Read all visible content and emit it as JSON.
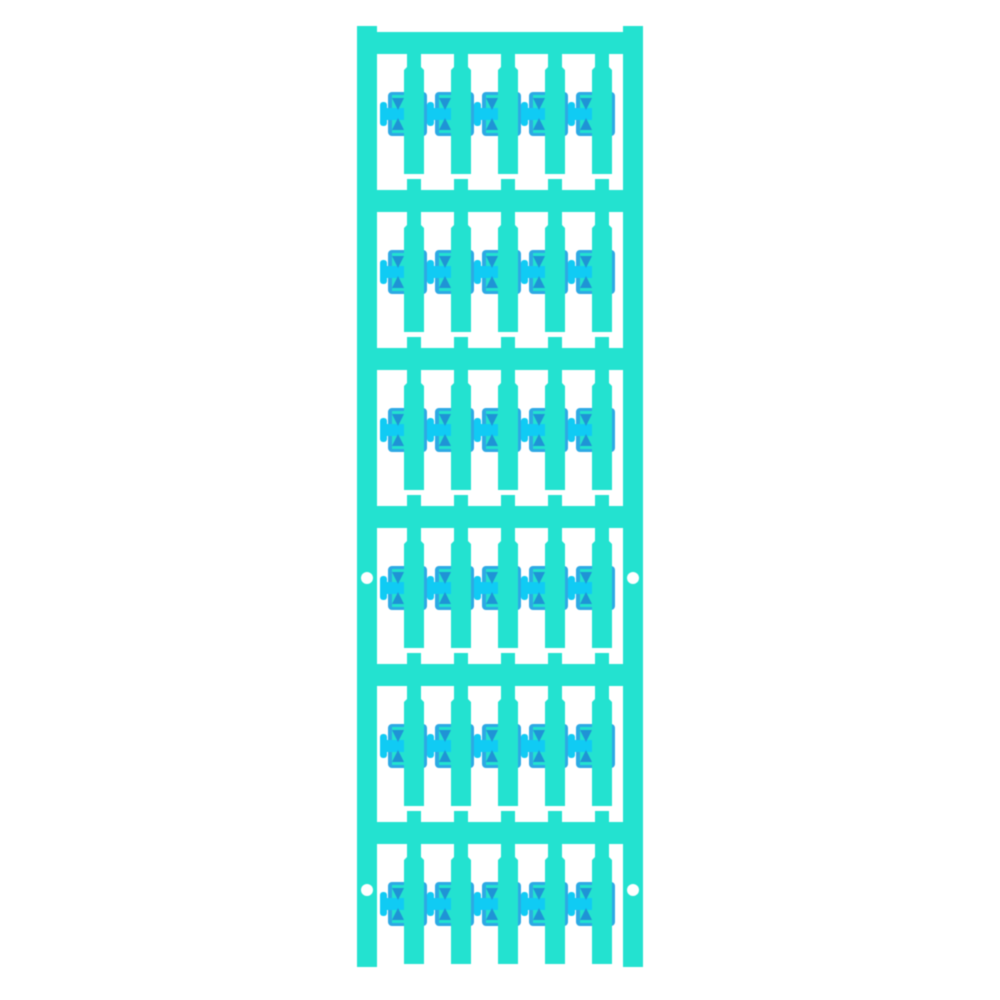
{
  "product": {
    "kind": "cable-marker-card",
    "description": "Turquoise plastic cable marker card: two vertical carrier rails joined by six crossbars, each crossbar carrying five hanging marker strips with a blue cable clip on each strip",
    "rows": 6,
    "columns": 5,
    "marker_count": 30,
    "mounting_hole_count": 4
  },
  "colors": {
    "background": "#ffffff",
    "carrier": "#23e2d0",
    "clip_body": "#2da9e4",
    "clip_bright": "#10cbf4",
    "clip_tooth": "#1f93d6",
    "hole": "#ffffff"
  },
  "geometry": {
    "canvas": {
      "width": 1000,
      "height": 1000
    },
    "rail_left_x": 357,
    "rail_right_x": 623,
    "rail_width": 20,
    "rail_top": 26,
    "rail_bottom": 967,
    "bar_tops": [
      32,
      190,
      348,
      506,
      664,
      822
    ],
    "bar_height": 22,
    "strip_xs": [
      404,
      451,
      498,
      545,
      592
    ],
    "strip_width": 20,
    "strip_top_offset": 22,
    "strip_length": 120,
    "neck_ratio_x1": "15%",
    "neck_ratio_x2": "85%",
    "neck_ratio_y1": "10.8%",
    "neck_ratio_y2": "13.3%",
    "stub_width": 14,
    "stub_height": 11,
    "clip": {
      "top_offset": 60,
      "body_left": -16,
      "body_width": 39,
      "body_height": 44,
      "window_left": -12,
      "window_top": 3,
      "window_width": 15,
      "window_height": 38,
      "tab_left": -24,
      "tab_top": 10,
      "tab_width": 7,
      "tab_height": 24,
      "band_left": -19,
      "band_top": 16,
      "band_width": 21,
      "band_height": 12,
      "tooth_size": 12,
      "tooth_top_upper": 6,
      "tooth_top_lower": 26
    },
    "holes": {
      "ys": [
        578,
        890
      ],
      "diameter": 12
    }
  }
}
